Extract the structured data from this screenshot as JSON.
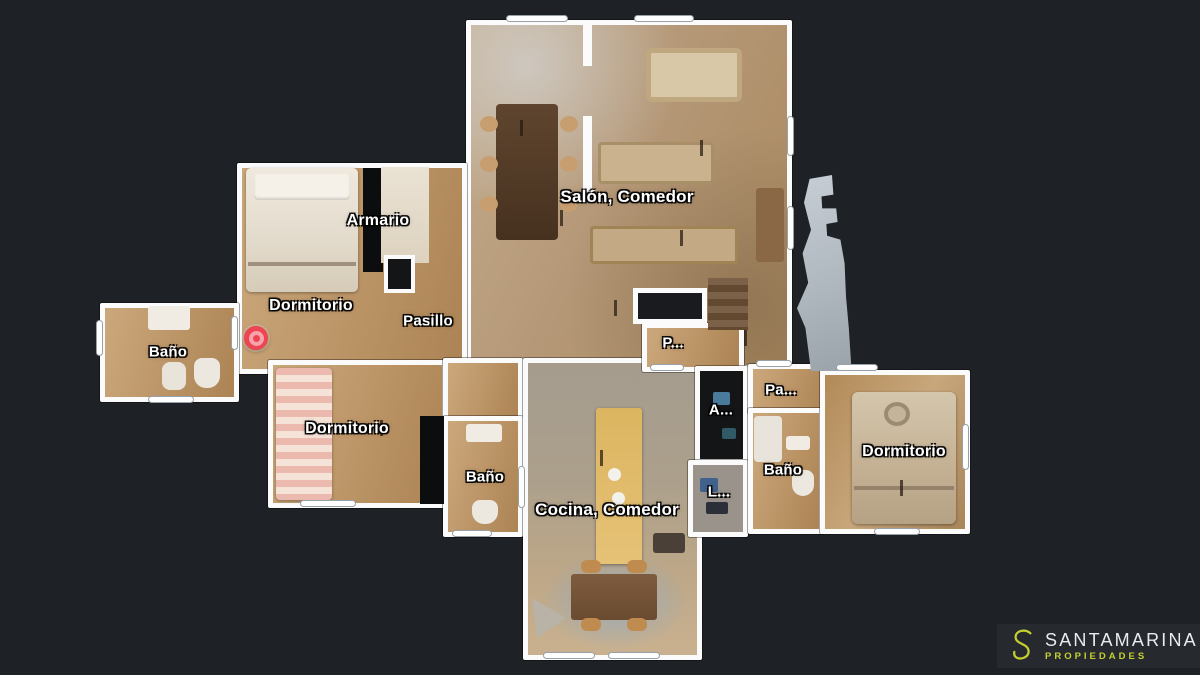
{
  "background": {
    "color": "#1e2126"
  },
  "floorplan": {
    "labels": [
      {
        "id": "salon",
        "text": "Salón, Comedor",
        "x": 627,
        "y": 197,
        "size": 17
      },
      {
        "id": "armario",
        "text": "Armario",
        "x": 378,
        "y": 221,
        "size": 16
      },
      {
        "id": "dormitorio-principal",
        "text": "Dormitorio",
        "x": 311,
        "y": 306,
        "size": 16
      },
      {
        "id": "pasillo",
        "text": "Pasillo",
        "x": 428,
        "y": 321,
        "size": 15
      },
      {
        "id": "bano-izquierdo",
        "text": "Baño",
        "x": 168,
        "y": 352,
        "size": 15
      },
      {
        "id": "p-corridor",
        "text": "P...",
        "x": 673,
        "y": 343,
        "size": 15
      },
      {
        "id": "pa-corridor",
        "text": "Pa...",
        "x": 781,
        "y": 390,
        "size": 15
      },
      {
        "id": "a-room",
        "text": "A...",
        "x": 721,
        "y": 410,
        "size": 15
      },
      {
        "id": "dormitorio-inferior",
        "text": "Dormitorio",
        "x": 347,
        "y": 429,
        "size": 16
      },
      {
        "id": "dormitorio-derecho",
        "text": "Dormitorio",
        "x": 904,
        "y": 452,
        "size": 16
      },
      {
        "id": "bano-central",
        "text": "Baño",
        "x": 485,
        "y": 477,
        "size": 15
      },
      {
        "id": "bano-derecho",
        "text": "Baño",
        "x": 783,
        "y": 470,
        "size": 15
      },
      {
        "id": "l-room",
        "text": "L...",
        "x": 719,
        "y": 492,
        "size": 15
      },
      {
        "id": "cocina",
        "text": "Cocina, Comedor",
        "x": 607,
        "y": 510,
        "size": 17
      }
    ],
    "marker": {
      "x": 256,
      "y": 338,
      "color": "#ee4553",
      "ring_color": "#f7a3ab"
    }
  },
  "branding": {
    "initial": "S",
    "name": "SANTAMARINA",
    "tagline": "PROPIEDADES",
    "accent_color": "#c6d02f",
    "name_color": "#e9ebed",
    "panel_color": "#26292e"
  }
}
